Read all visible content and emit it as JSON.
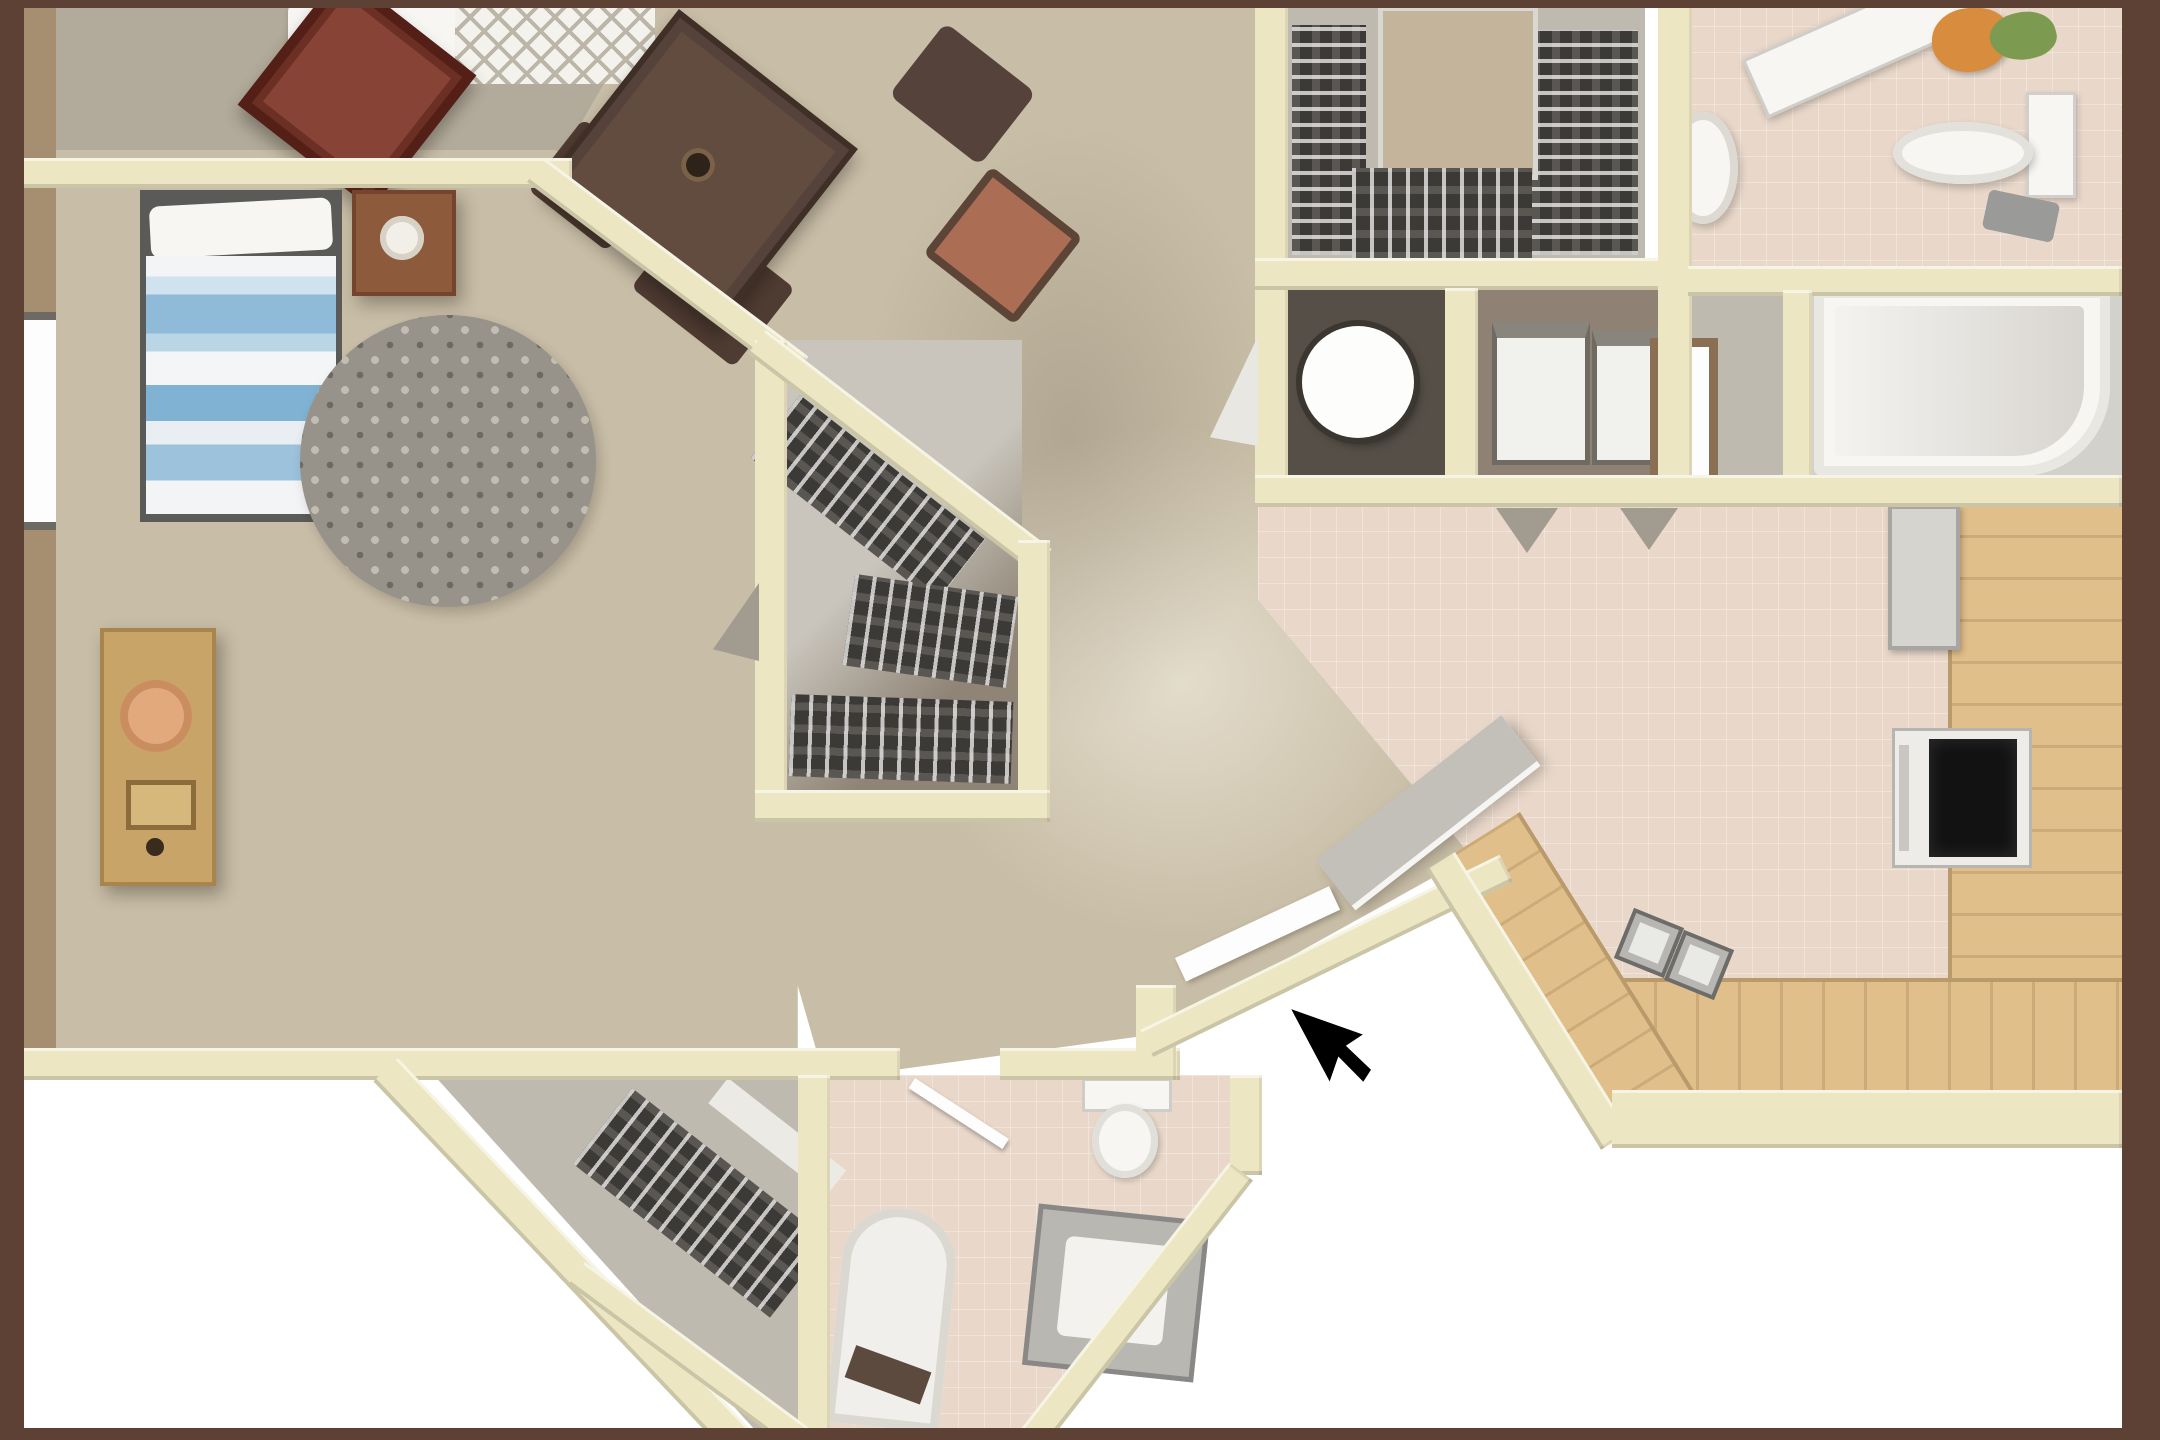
{
  "scene": {
    "kind": "3d-floorplan-render",
    "view": "top-down",
    "has_text": false,
    "cursor": {
      "x": 1313,
      "y": 988,
      "shape": "black-arrow-pointer"
    }
  },
  "palette": {
    "frame": "#5d4134",
    "outside": "#ffffff",
    "wall": "#ece6c3",
    "wall-edge": "#d8d1a8",
    "outer-wall-tan": "#a68e70",
    "carpet-tan": "#c8bda6",
    "carpet-light": "#d8cfba",
    "top-room-floor": "#b2aa9a",
    "tile-pink": "#e9d8ca",
    "gray-floor": "#bfbab0",
    "dark-floor": "#554f48",
    "brown-floor": "#8f8173",
    "wood": "#e0bf8a",
    "fixture-white": "#f7f6f3",
    "fixture-shadow": "#d9d6d1",
    "steel": "#b5b3af",
    "bed-blue": "#7fb2d3",
    "bed-blue-light": "#bad5e6",
    "rug-base": "#98938a",
    "chair-maroon": "#6b2f24",
    "chair-maroon-inner": "#884337",
    "table-brown": "#55423a",
    "terracotta": "#ab6e55",
    "clothes": "#3c3a37",
    "nightstand-brown": "#8d5a3c",
    "desk-gold": "#c8a468",
    "lamp-peach": "#e2a97c",
    "door-gray": "#c3c0b9",
    "swing-gray": "#a29b90",
    "plant-orange": "#d78c3e",
    "plant-green": "#7d9b50",
    "cursor": "#000000"
  },
  "rooms": [
    {
      "name": "den-top-left",
      "floor": "top-room-floor"
    },
    {
      "name": "bedroom",
      "floor": "carpet-tan"
    },
    {
      "name": "living-dining",
      "floor": "carpet-tan"
    },
    {
      "name": "walk-in-closet-pentagon",
      "floor": "gray-floor"
    },
    {
      "name": "wardrobe-closet-top",
      "floor": "gray-floor"
    },
    {
      "name": "laundry-round-machine",
      "floor": "dark-floor"
    },
    {
      "name": "laundry-two-machines",
      "floor": "brown-floor"
    },
    {
      "name": "bathroom-top-right",
      "floor": "tile-pink"
    },
    {
      "name": "water-closet",
      "floor": "gray-floor"
    },
    {
      "name": "bathtub-alcove",
      "floor": "gray-floor"
    },
    {
      "name": "kitchen",
      "floor": "tile-pink"
    },
    {
      "name": "hall-closet-bottom",
      "floor": "gray-floor"
    },
    {
      "name": "bathroom-bottom",
      "floor": "tile-pink"
    }
  ],
  "furniture": [
    "armchair-dark-maroon",
    "patterned-rug",
    "white-sofa-blanket",
    "bed-blue-striped",
    "pillow",
    "nightstand-with-lamp",
    "round-speckled-rug",
    "dresser-desk-with-lamp",
    "window-left-wall",
    "dining-table",
    "dining-chairs",
    "terracotta-chair-cushions",
    "hanging-clothes-racks",
    "closet-shelf",
    "washing-machine-round",
    "washer-dryer-squares",
    "vanity-counter",
    "pedestal-sink",
    "toilet-top-right",
    "potted-plant",
    "towel",
    "bathtub-top-right",
    "framed-mirror",
    "refrigerator",
    "stove-black-cooktop",
    "kitchen-counter-L",
    "double-basin-sink",
    "door-swing-triangles",
    "open-door-slab",
    "white-door-leaf",
    "bathtub-bottom",
    "vanity-bottom",
    "toilet-bottom",
    "clothes-rack-bottom"
  ]
}
